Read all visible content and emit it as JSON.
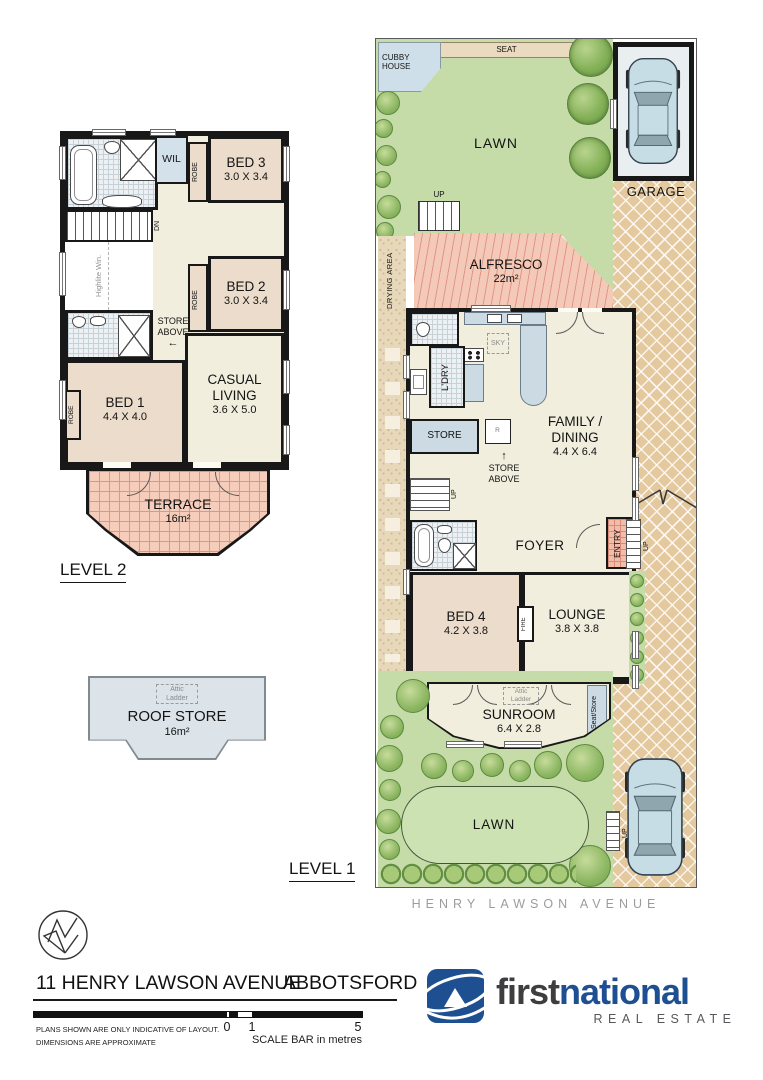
{
  "colors": {
    "brand_blue": "#1d4f91",
    "wall_black": "#181818",
    "grass_green": "#c5dca8",
    "deck_pink": "#f5c9b8",
    "paving_tan": "#e4c99f",
    "room_tan": "#ecdccb",
    "floor_cream": "#f1eedd",
    "joinery_blue": "#ccdae4"
  },
  "icons": {
    "arrow_left": "←",
    "arrow_up": "↑"
  },
  "common": {
    "robe": "ROBE",
    "up": "UP",
    "lawn": "LAWN",
    "store": "STORE",
    "above": "ABOVE",
    "attic_line1": "Attic",
    "attic_line2": "Ladder"
  },
  "level2": {
    "title": "LEVEL 2",
    "wil": "WIL",
    "dn": "DN",
    "highlite_win": "Highlite Win.",
    "bed3_name": "BED 3",
    "bed3_dims": "3.0 X 3.4",
    "bed2_name": "BED 2",
    "bed2_dims": "3.0 X 3.4",
    "bed1_name": "BED 1",
    "bed1_dims": "4.4 X 4.0",
    "casual_line1": "CASUAL",
    "casual_line2": "LIVING",
    "casual_dims": "3.6 X 5.0",
    "terrace_name": "TERRACE",
    "terrace_area": "16m²"
  },
  "roof": {
    "name": "ROOF STORE",
    "area": "16m²"
  },
  "level1": {
    "title": "LEVEL 1",
    "cubby_line1": "CUBBY",
    "cubby_line2": "HOUSE",
    "seat": "SEAT",
    "garage": "GARAGE",
    "drying_area": "DRYING AREA",
    "alfresco_name": "ALFRESCO",
    "alfresco_area": "22m²",
    "ldry": "L'DRY",
    "sky": "SKY",
    "fridge": "R",
    "family_line1": "FAMILY /",
    "family_line2": "DINING",
    "family_dims": "4.4 X 6.4",
    "foyer": "FOYER",
    "entry": "ENTRY",
    "bed4_name": "BED 4",
    "bed4_dims": "4.2 X 3.8",
    "fire": "FIRE",
    "lounge_name": "LOUNGE",
    "lounge_dims": "3.8 X 3.8",
    "sunroom_name": "SUNROOM",
    "sunroom_dims": "6.4 X 2.8",
    "seat_store": "Seat/Store",
    "street": "HENRY LAWSON AVENUE"
  },
  "footer": {
    "address": "11 HENRY LAWSON AVENUE",
    "suburb": "ABBOTSFORD",
    "disclaimer1": "PLANS SHOWN ARE ONLY INDICATIVE OF LAYOUT.",
    "disclaimer2": "DIMENSIONS ARE APPROXIMATE",
    "scale_caption": "SCALE BAR in metres",
    "tick0": "0",
    "tick1": "1",
    "tick5": "5"
  },
  "brand": {
    "word1": "first",
    "word2": "national",
    "tagline": "REAL ESTATE"
  }
}
